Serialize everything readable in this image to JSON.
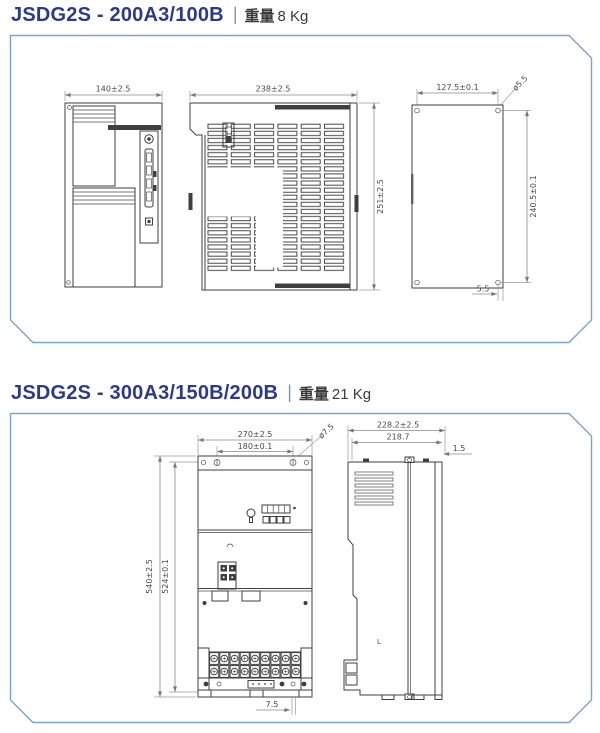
{
  "page": {
    "background": "#ffffff",
    "panel_border": "#7da2cf"
  },
  "sections": [
    {
      "model": "JSDG2S - 200A3/100B",
      "divider": "|",
      "weight_label": "重量",
      "weight_value": "8 Kg",
      "dims": {
        "front_width": "140±2.5",
        "vent_width": "238±2.5",
        "vent_height": "251±2.5",
        "plate_width": "127.5±0.1",
        "plate_hole_dia": "ø5.5",
        "plate_height": "240.5±0.1",
        "plate_edge_offset": "5.5"
      }
    },
    {
      "model": "JSDG2S - 300A3/150B/200B",
      "divider": "|",
      "weight_label": "重量",
      "weight_value": "21 Kg",
      "dims": {
        "front_width": "270±2.5",
        "hole_span": "180±0.1",
        "hole_dia": "ø7.5",
        "front_height": "540±2.5",
        "hole_height": "524±0.1",
        "bottom_hole_offset": "7.5",
        "side_depth": "228.2±2.5",
        "side_inner_depth": "218.7",
        "plate_thickness": "1.5",
        "side_mark": "L"
      }
    }
  ]
}
